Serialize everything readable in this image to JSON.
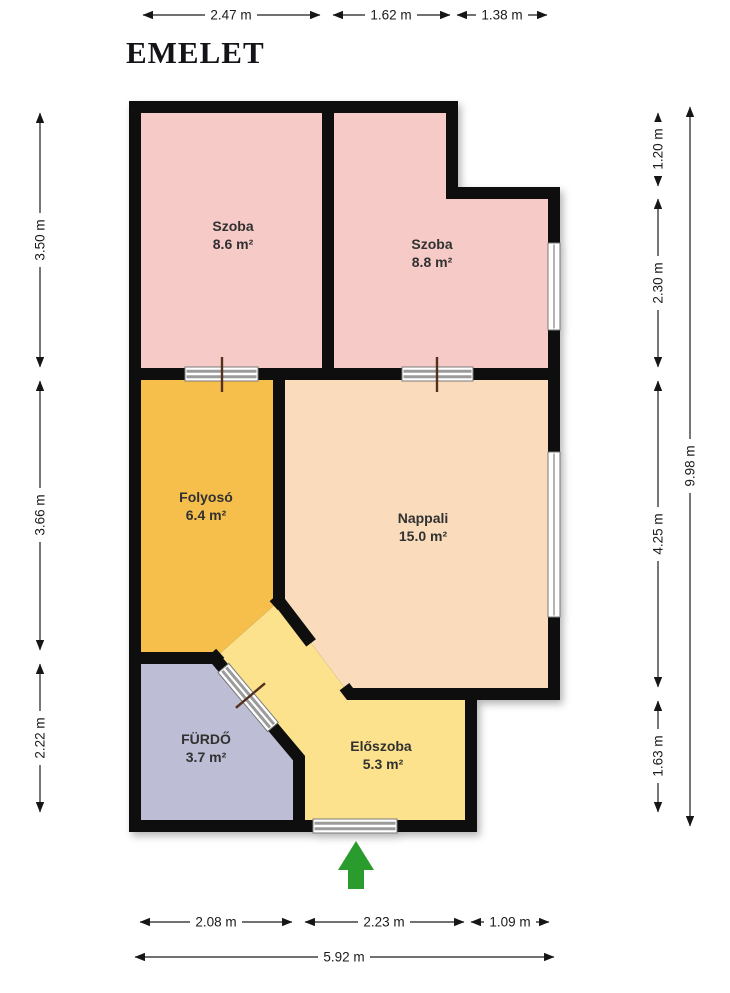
{
  "title": "EMELET",
  "rooms": [
    {
      "name": "Szoba",
      "area": "8.6 m²",
      "color": "#f6cbc7"
    },
    {
      "name": "Szoba",
      "area": "8.8 m²",
      "color": "#f6cbc7"
    },
    {
      "name": "Folyosó",
      "area": "6.4 m²",
      "color": "#f6bf4b"
    },
    {
      "name": "Nappali",
      "area": "15.0 m²",
      "color": "#fadcbd"
    },
    {
      "name": "FÜRDŐ",
      "area": "3.7 m²",
      "color": "#bdbdd5"
    },
    {
      "name": "Előszoba",
      "area": "5.3 m²",
      "color": "#fce28c"
    }
  ],
  "dimensions": {
    "top": [
      "2.47 m",
      "1.62 m",
      "1.38 m"
    ],
    "left": [
      "3.50 m",
      "3.66 m",
      "2.22 m"
    ],
    "right": [
      "1.20 m",
      "2.30 m",
      "4.25 m",
      "1.63 m"
    ],
    "right_total": "9.98 m",
    "bottom": [
      "2.08 m",
      "2.23 m",
      "1.09 m"
    ],
    "bottom_total": "5.92 m"
  },
  "colors": {
    "wall": "#0e0e0e",
    "title": "#131318",
    "entrance_arrow": "#2a9c2d"
  }
}
